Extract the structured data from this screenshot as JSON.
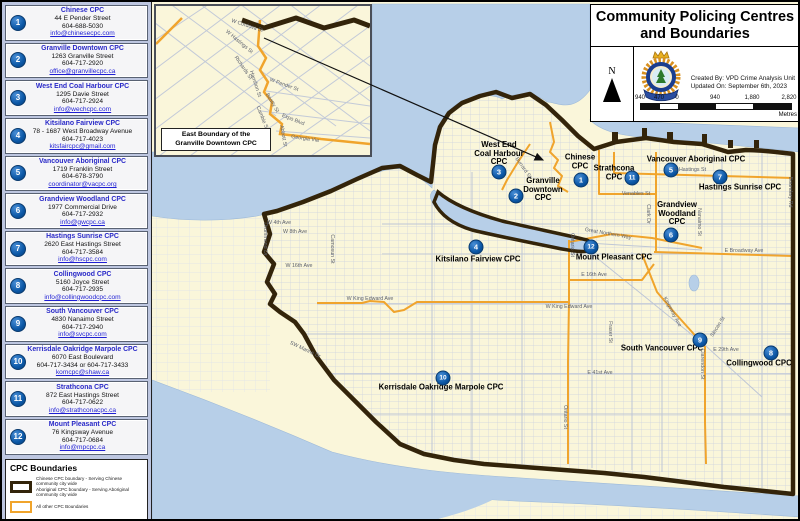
{
  "title_panel": {
    "title_line1": "Community Policing Centres",
    "title_line2": "and Boundaries",
    "north_label": "N",
    "created_by": "Created By: VPD Crime Analysis Unit",
    "updated_on": "Updated On: September 6th, 2023",
    "scale": {
      "labels": [
        "940",
        "470",
        "0",
        "940",
        "1,880",
        "2,820"
      ],
      "unit": "Metres"
    }
  },
  "sidebar": {
    "items": [
      {
        "num": "1",
        "name": "Chinese CPC",
        "lines": [
          "44 E Pender Street",
          "604-688-5030"
        ],
        "email": "info@chinesecpc.com"
      },
      {
        "num": "2",
        "name": "Granville Downtown CPC",
        "lines": [
          "1263 Granville Street",
          "604-717-2920"
        ],
        "email": "office@granvillecpc.ca"
      },
      {
        "num": "3",
        "name": "West End Coal Harbour CPC",
        "lines": [
          "1295 Davie Street",
          "604-717-2924"
        ],
        "email": "info@wechcpc.com"
      },
      {
        "num": "4",
        "name": "Kitsilano Fairview CPC",
        "lines": [
          "78 - 1687 West Broadway Avenue",
          "604-717-4023"
        ],
        "email": "kitsfaircpc@gmail.com"
      },
      {
        "num": "5",
        "name": "Vancouver Aboriginal CPC",
        "lines": [
          "1719 Franklin Street",
          "604-678-3790"
        ],
        "email": "coordinator@vacpc.org"
      },
      {
        "num": "6",
        "name": "Grandview Woodland CPC",
        "lines": [
          "1977 Commercial Drive",
          "604-717-2932"
        ],
        "email": "info@gwcpc.ca"
      },
      {
        "num": "7",
        "name": "Hastings Sunrise CPC",
        "lines": [
          "2620 East Hastings Street",
          "604-717-3584"
        ],
        "email": "info@hscpc.com"
      },
      {
        "num": "8",
        "name": "Collingwood CPC",
        "lines": [
          "5160 Joyce Street",
          "604-717-2935"
        ],
        "email": "info@collingwoodcpc.com"
      },
      {
        "num": "9",
        "name": "South Vancouver CPC",
        "lines": [
          "4830 Nanaimo Street",
          "604-717-2940"
        ],
        "email": "info@svcpc.com"
      },
      {
        "num": "10",
        "name": "Kerrisdale Oakridge Marpole CPC",
        "lines": [
          "6070 East Boulevard",
          "604-717-3434 or 604-717-3433"
        ],
        "email": "komcpc@shaw.ca"
      },
      {
        "num": "11",
        "name": "Strathcona CPC",
        "lines": [
          "872 East Hastings Street",
          "604-717-0622"
        ],
        "email": "info@strathconacpc.ca"
      },
      {
        "num": "12",
        "name": "Mount Pleasant CPC",
        "lines": [
          "76 Kingsway Avenue",
          "604-717-0684"
        ],
        "email": "info@mpcpc.ca"
      }
    ]
  },
  "legend": {
    "title": "CPC Boundaries",
    "entries": [
      {
        "swatch": "dark",
        "lines": [
          "Chinese CPC boundary - Serving Chinese community city wide",
          "Aboriginal CPC boundary - Serving Aboriginal community city wide"
        ]
      },
      {
        "swatch": "orange",
        "lines": [
          "All other CPC Boundaries"
        ]
      }
    ]
  },
  "inset": {
    "caption_line1": "East Boundary of the",
    "caption_line2": "Granville Downtown CPC",
    "streets": [
      {
        "text": "W Cordova St",
        "x": 91,
        "y": 20,
        "rot": 18
      },
      {
        "text": "W Hastings St",
        "x": 83,
        "y": 36,
        "rot": 40
      },
      {
        "text": "Richards St",
        "x": 87,
        "y": 62,
        "rot": 55
      },
      {
        "text": "Hamilton St",
        "x": 99,
        "y": 78,
        "rot": 72
      },
      {
        "text": "W Pender St",
        "x": 128,
        "y": 79,
        "rot": 20
      },
      {
        "text": "Beatty St",
        "x": 116,
        "y": 97,
        "rot": 60
      },
      {
        "text": "Cambie St",
        "x": 106,
        "y": 112,
        "rot": 68
      },
      {
        "text": "Expo Blvd",
        "x": 137,
        "y": 114,
        "rot": 22
      },
      {
        "text": "Georgia Via",
        "x": 149,
        "y": 133,
        "rot": 8
      },
      {
        "text": "Abbott St",
        "x": 127,
        "y": 130,
        "rot": 80
      }
    ]
  },
  "map": {
    "cpc_labels": [
      {
        "num": "1",
        "lines": [
          "Chinese",
          "CPC"
        ],
        "x": 578,
        "y": 160,
        "mx": 579,
        "my": 178
      },
      {
        "num": "2",
        "lines": [
          "Granville",
          "Downtown",
          "CPC"
        ],
        "x": 541,
        "y": 188,
        "mx": 514,
        "my": 194
      },
      {
        "num": "3",
        "lines": [
          "West End",
          "Coal Harbour",
          "CPC"
        ],
        "x": 497,
        "y": 152,
        "mx": 497,
        "my": 170
      },
      {
        "num": "4",
        "lines": [
          "Kitsilano Fairview CPC"
        ],
        "x": 476,
        "y": 258,
        "mx": 474,
        "my": 245
      },
      {
        "num": "5",
        "lines": [
          "Vancouver Aboriginal CPC"
        ],
        "x": 694,
        "y": 158,
        "mx": 669,
        "my": 168
      },
      {
        "num": "6",
        "lines": [
          "Grandview",
          "Woodland",
          "CPC"
        ],
        "x": 675,
        "y": 212,
        "mx": 669,
        "my": 233
      },
      {
        "num": "7",
        "lines": [
          "Hastings Sunrise CPC"
        ],
        "x": 738,
        "y": 186,
        "mx": 718,
        "my": 175
      },
      {
        "num": "8",
        "lines": [
          "Collingwood CPC"
        ],
        "x": 757,
        "y": 362,
        "mx": 769,
        "my": 351
      },
      {
        "num": "9",
        "lines": [
          "South Vancouver CPC"
        ],
        "x": 660,
        "y": 347,
        "mx": 698,
        "my": 338
      },
      {
        "num": "10",
        "lines": [
          "Kerrisdale Oakridge Marpole CPC"
        ],
        "x": 439,
        "y": 386,
        "mx": 441,
        "my": 376
      },
      {
        "num": "11",
        "lines": [
          "Strathcona",
          "CPC"
        ],
        "x": 612,
        "y": 171,
        "mx": 630,
        "my": 176
      },
      {
        "num": "12",
        "lines": [
          "Mount Pleasant CPC"
        ],
        "x": 612,
        "y": 256,
        "mx": 589,
        "my": 245
      }
    ],
    "street_labels": [
      {
        "text": "Burrard St",
        "x": 521,
        "y": 166,
        "rot": 55
      },
      {
        "text": "W 4th Ave",
        "x": 277,
        "y": 221,
        "rot": 0
      },
      {
        "text": "W 8th Ave",
        "x": 293,
        "y": 230,
        "rot": 0
      },
      {
        "text": "W 16th Ave",
        "x": 297,
        "y": 264,
        "rot": 0
      },
      {
        "text": "Drummond Dr",
        "x": 263,
        "y": 237,
        "rot": 90
      },
      {
        "text": "Camosun St",
        "x": 330,
        "y": 247,
        "rot": 90
      },
      {
        "text": "SW Marine Dr",
        "x": 303,
        "y": 348,
        "rot": 25
      },
      {
        "text": "W King Edward Ave",
        "x": 368,
        "y": 297,
        "rot": 0
      },
      {
        "text": "W King Edward Ave",
        "x": 567,
        "y": 305,
        "rot": 0
      },
      {
        "text": "E 16th Ave",
        "x": 592,
        "y": 273,
        "rot": 0
      },
      {
        "text": "Ontario St",
        "x": 570,
        "y": 243,
        "rot": 90
      },
      {
        "text": "Ontario St",
        "x": 563,
        "y": 415,
        "rot": 90
      },
      {
        "text": "Fraser St",
        "x": 608,
        "y": 330,
        "rot": 90
      },
      {
        "text": "Kingsway Ave",
        "x": 670,
        "y": 310,
        "rot": 62
      },
      {
        "text": "Clarendon St",
        "x": 700,
        "y": 362,
        "rot": 90
      },
      {
        "text": "E 41st Ave",
        "x": 598,
        "y": 371,
        "rot": 0
      },
      {
        "text": "E 29th Ave",
        "x": 724,
        "y": 348,
        "rot": 0
      },
      {
        "text": "Slocan St",
        "x": 716,
        "y": 325,
        "rot": -58
      },
      {
        "text": "E Broadway Ave",
        "x": 742,
        "y": 249,
        "rot": 0
      },
      {
        "text": "E Hastings St",
        "x": 688,
        "y": 168,
        "rot": 0
      },
      {
        "text": "Venables St",
        "x": 634,
        "y": 192,
        "rot": 0
      },
      {
        "text": "Clark Dr",
        "x": 646,
        "y": 212,
        "rot": 90
      },
      {
        "text": "Nanaimo St",
        "x": 697,
        "y": 220,
        "rot": 90
      },
      {
        "text": "Boundary Rd",
        "x": 788,
        "y": 190,
        "rot": 90
      },
      {
        "text": "Great Northern Way",
        "x": 606,
        "y": 232,
        "rot": 10
      }
    ]
  },
  "colors": {
    "land": "#faf6da",
    "water": "#b7cfe8",
    "boundary_dark": "#33240a",
    "boundary_orange": "#f0a42c",
    "marker_blue": "#0b57a6",
    "name_blue": "#2a2ac8",
    "link_blue": "#1f1fd4",
    "sidebar_bg": "#bdc6e0"
  }
}
